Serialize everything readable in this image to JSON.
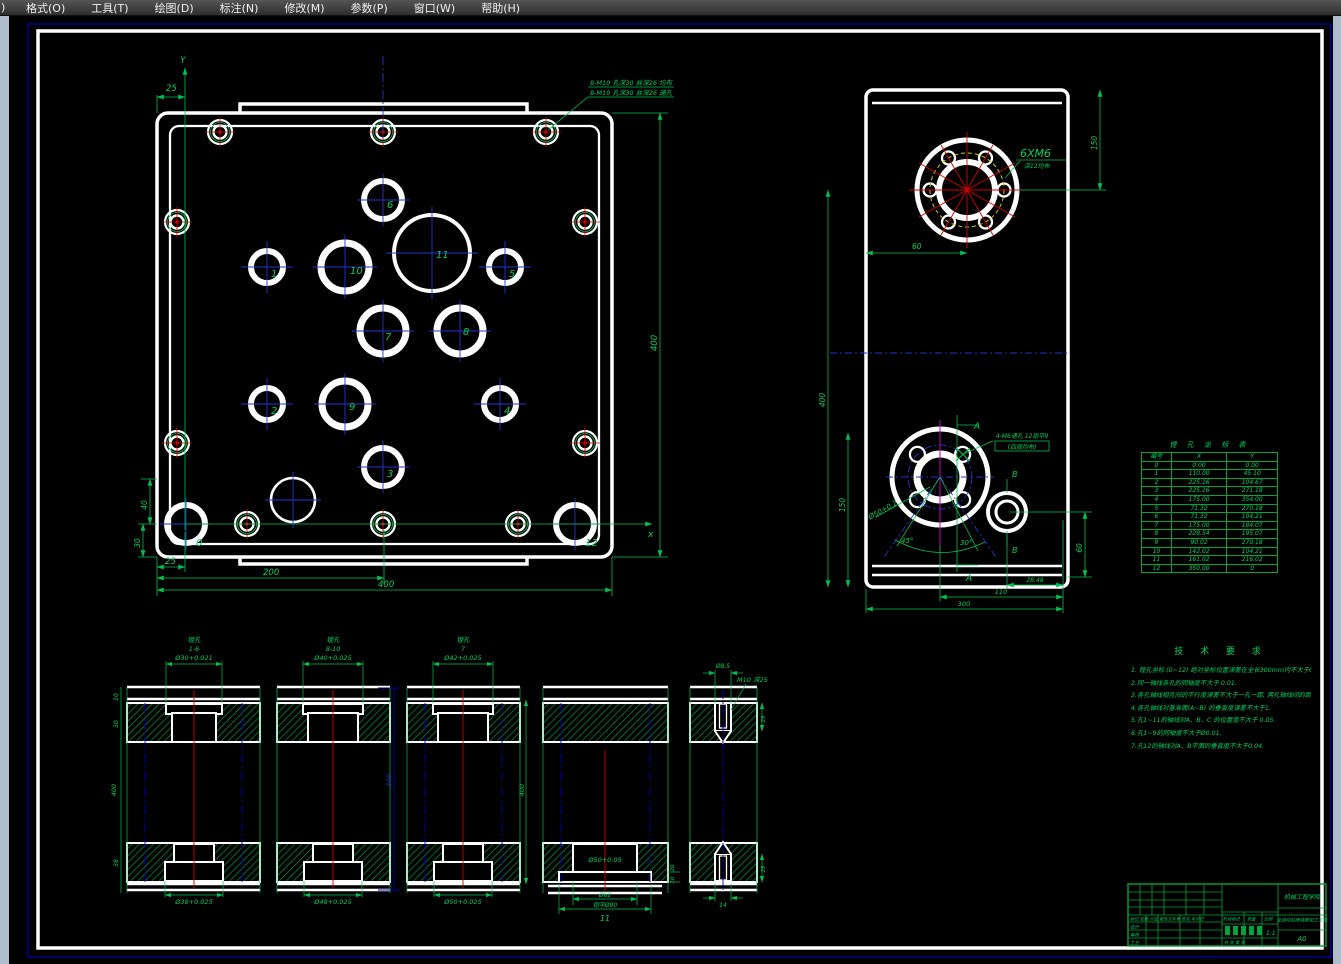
{
  "app": {
    "menu_clipped": ")",
    "menu": [
      "格式(O)",
      "工具(T)",
      "绘图(D)",
      "标注(N)",
      "修改(M)",
      "参数(P)",
      "窗口(W)",
      "帮助(H)"
    ]
  },
  "colors": {
    "annotation_green": "#00c050",
    "centerline_red": "#d40000",
    "centerline_blue": "#2233d0",
    "hidden_navy": "#0000b0",
    "bolt_circle_yellow": "#c8c800",
    "magenta": "#c000c0",
    "geometry_white": "#ffffff",
    "paper_border_navy": "#000099",
    "hatch_green": "#00953a",
    "menu_bg": "#3f3f3f",
    "edge_strip": "#aebccb"
  },
  "front": {
    "axis_x": "x",
    "axis_y": "Y",
    "leader1": "8-M10 孔深30 丝深26 均布",
    "leader2": "8-M10 孔深30 丝深26 通孔",
    "dims": {
      "top25": "25",
      "right400": "400",
      "b25": "25",
      "b200": "200",
      "b400": "400",
      "v40": "40",
      "v30": "30"
    },
    "hole_labels": [
      "0",
      "1",
      "2",
      "3",
      "4",
      "5",
      "6",
      "7",
      "8",
      "9",
      "10",
      "11",
      "12"
    ]
  },
  "side": {
    "flange_label": "6XM6",
    "flange_sub": "深12均布",
    "leader1": "4-M6通孔 12锪平9",
    "leader2": "(四周均布)",
    "dia50": "Ø50+0.2",
    "angle_l": "45°",
    "angle_r": "30°",
    "a": "A",
    "b": "B",
    "dims": {
      "right150": "150",
      "top60": "60",
      "left400": "400",
      "left150": "150",
      "d2848": "28.48",
      "d110": "110",
      "d300": "300",
      "right60": "60"
    }
  },
  "sections": {
    "s1": {
      "t1": "镗孔",
      "t2": "1-6",
      "topd": "Ø30+0.021",
      "botd": "Ø38+0.025",
      "d10": "10",
      "d30": "30",
      "d400": "400",
      "d38": "38"
    },
    "s2": {
      "t1": "镗孔",
      "t2": "8-10",
      "topd": "Ø40+0.025",
      "botd": "Ø48+0.025",
      "d500": "500"
    },
    "s3": {
      "t1": "镗孔",
      "t2": "7",
      "topd": "Ø42+0.025",
      "botd": "Ø50+0.025",
      "d400": "400"
    },
    "s4": {
      "bore": "Ø50+0.05",
      "d62": "Ø62",
      "d90": "锪平Ø90",
      "num": "11",
      "d20": "20",
      "d10": "10"
    },
    "s5": {
      "topd": "Ø8.5",
      "thread": "M10 深25",
      "d25a": "25",
      "d25b": "25",
      "d14": "14"
    }
  },
  "coord_table": {
    "title": "镗 孔 坐 标 表",
    "headers": [
      "编号",
      "X",
      "Y"
    ],
    "rows": [
      [
        "0",
        "0.00",
        "0.00"
      ],
      [
        "1",
        "110.00",
        "45.10"
      ],
      [
        "2",
        "225.16",
        "104.67"
      ],
      [
        "3",
        "225.16",
        "271.18"
      ],
      [
        "4",
        "175.00",
        "354.00"
      ],
      [
        "5",
        "71.32",
        "270.18"
      ],
      [
        "6",
        "71.32",
        "104.21"
      ],
      [
        "7",
        "175.00",
        "184.07"
      ],
      [
        "8",
        "228.54",
        "195.07"
      ],
      [
        "9",
        "90.02",
        "270.18"
      ],
      [
        "10",
        "142.02",
        "104.21"
      ],
      [
        "11",
        "161.02",
        "216.02"
      ],
      [
        "12",
        "350.00",
        "0"
      ]
    ]
  },
  "tech": {
    "title": "技 术 要 求",
    "lines": [
      "1. 镗孔坐标.(0~12) 绝对坐标位置误差在全长300mm内不大于0.03.",
      "2.同一轴线各孔的同轴度不大于 0.01.",
      "3.各孔轴线相互间的平行度误差不大于一孔一距, 两孔轴线间的距离误差不大于±0.02。",
      "4.各孔轴线对基准面(A~B) 的垂直度误差不大于1.",
      "5.孔1~11的轴线对A、B、C 的位置度不大于 0.05.",
      "6.孔1~9的同轴度不大于Ø0.01.",
      "7.孔12的轴线对A、B平面的垂直度不大于0.04."
    ]
  },
  "tb": {
    "school": "机械工程学院",
    "project": "全自动钻床底座加工工艺",
    "sheet": "A0",
    "row_header": "标记 处数 分区 更改文件号 签名 年月日",
    "design": "设计",
    "audit": "审核",
    "process": "工艺",
    "stage": "阶段标记",
    "mass": "质量",
    "scale_label": "比例",
    "scale": "1:1",
    "sheets": "共 张 第 张"
  }
}
